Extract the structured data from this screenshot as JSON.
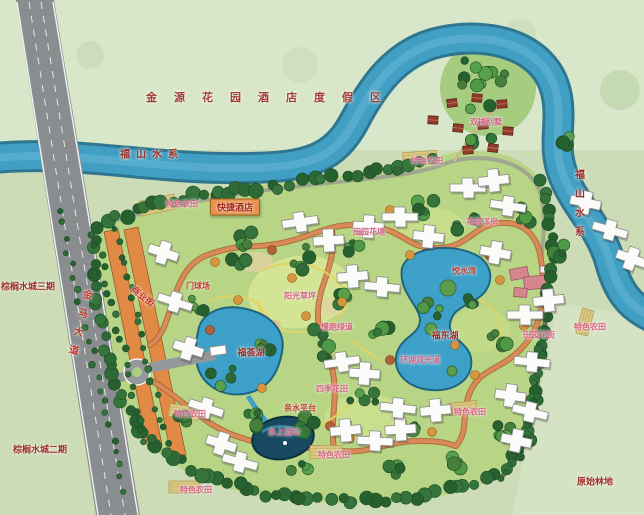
{
  "map": {
    "type": "resort-master-plan",
    "title": "金源花园酒店度假区",
    "colors": {
      "background_green": "#ccdcb6",
      "top_area_green": "#d8e7c9",
      "site_lawn": "#b7d584",
      "river_water": "#419fc3",
      "river_edge": "#26708e",
      "lake_water": "#3da0c8",
      "dark_pond": "#174a60",
      "main_road_grey": "#898d90",
      "internal_road": "#d98a58",
      "commercial_orange": "#e08a45",
      "building_white": "#fbfbf9",
      "villa_red": "#8e3b2c",
      "clubhouse_pink": "#d6868f",
      "label_pink": "#d46184",
      "label_red": "#c13a2d",
      "label_dark_red": "#9c2f27"
    }
  },
  "labels": [
    {
      "name": "resort-area-title",
      "text": "金源花园酒店度假区",
      "x": 272,
      "y": 97,
      "cls": "lbl-spaced",
      "fs": 11
    },
    {
      "name": "river-name-west",
      "text": "福山水系",
      "x": 152,
      "y": 153,
      "cls": "lbl-dark lbl-sp6",
      "fs": 10
    },
    {
      "name": "river-name-east",
      "text": "福山水系",
      "x": 578,
      "y": 207,
      "cls": "lbl-dark lbl-vert",
      "fs": 10
    },
    {
      "name": "palm-water-city-phase3",
      "text": "棕榈水城三期",
      "x": 28,
      "y": 286,
      "cls": "lbl-dark",
      "fs": 9
    },
    {
      "name": "palm-water-city-phase2",
      "text": "棕榈水城二期",
      "x": 40,
      "y": 449,
      "cls": "lbl-dark",
      "fs": 9
    },
    {
      "name": "jinma-avenue",
      "text": "金马大道",
      "x": 78,
      "y": 326,
      "cls": "lbl-red lbl-vert",
      "fs": 10,
      "rot": 14
    },
    {
      "name": "farm-plot-northwest",
      "text": "特色农田",
      "x": 182,
      "y": 204,
      "cls": "lbl-pink",
      "fs": 8
    },
    {
      "name": "express-hotel",
      "text": "快捷酒店",
      "x": 235,
      "y": 207,
      "cls": "lbl-box",
      "fs": 9
    },
    {
      "name": "duplex-villas",
      "text": "双拼别墅",
      "x": 486,
      "y": 122,
      "cls": "lbl-pink",
      "fs": 8
    },
    {
      "name": "farm-plot-north",
      "text": "特色农田",
      "x": 427,
      "y": 161,
      "cls": "lbl-pink",
      "fs": 8
    },
    {
      "name": "pastoral-flower-border",
      "text": "田园花境",
      "x": 369,
      "y": 232,
      "cls": "lbl-pink",
      "fs": 8
    },
    {
      "name": "garden-houses",
      "text": "花园洋房",
      "x": 482,
      "y": 222,
      "cls": "lbl-pink",
      "fs": 8
    },
    {
      "name": "sunshine-lawn",
      "text": "阳光草坪",
      "x": 300,
      "y": 296,
      "cls": "lbl-pink",
      "fs": 8
    },
    {
      "name": "jogging-greenway",
      "text": "慢跑绿道",
      "x": 337,
      "y": 327,
      "cls": "lbl-pink",
      "fs": 8
    },
    {
      "name": "west-lake-name",
      "text": "福荟湖",
      "x": 251,
      "y": 352,
      "cls": "lbl-dark",
      "fs": 9
    },
    {
      "name": "commercial-street",
      "text": "商业街",
      "x": 143,
      "y": 296,
      "cls": "lbl-red",
      "fs": 9,
      "rot": 38
    },
    {
      "name": "gateball-court",
      "text": "门球场",
      "x": 198,
      "y": 286,
      "cls": "lbl-red",
      "fs": 8
    },
    {
      "name": "lakeside-club",
      "text": "悦水湾",
      "x": 464,
      "y": 271,
      "cls": "lbl-red",
      "fs": 8
    },
    {
      "name": "east-lake-name",
      "text": "福东湖",
      "x": 445,
      "y": 335,
      "cls": "lbl-dark",
      "fs": 9
    },
    {
      "name": "lake-tour-path",
      "text": "环湖观光道",
      "x": 420,
      "y": 360,
      "cls": "lbl-pink",
      "fs": 8
    },
    {
      "name": "four-seasons-flower-field",
      "text": "四季花田",
      "x": 332,
      "y": 389,
      "cls": "lbl-pink",
      "fs": 8
    },
    {
      "name": "waterfront-platform",
      "text": "亲水平台",
      "x": 300,
      "y": 408,
      "cls": "lbl-red",
      "fs": 8
    },
    {
      "name": "water-sports",
      "text": "水上运动",
      "x": 284,
      "y": 432,
      "cls": "lbl-pink",
      "fs": 8
    },
    {
      "name": "pastoral-flower-street",
      "text": "田园花街",
      "x": 539,
      "y": 335,
      "cls": "lbl-pink",
      "fs": 8
    },
    {
      "name": "farm-plot-east",
      "text": "特色农田",
      "x": 590,
      "y": 327,
      "cls": "lbl-pink",
      "fs": 8
    },
    {
      "name": "farm-plot-southwest",
      "text": "特色农田",
      "x": 190,
      "y": 414,
      "cls": "lbl-pink",
      "fs": 8
    },
    {
      "name": "farm-plot-south",
      "text": "特色农田",
      "x": 334,
      "y": 455,
      "cls": "lbl-pink",
      "fs": 8
    },
    {
      "name": "farm-plot-southeast",
      "text": "特色农田",
      "x": 470,
      "y": 412,
      "cls": "lbl-pink",
      "fs": 8
    },
    {
      "name": "farm-plot-bottom",
      "text": "特色农田",
      "x": 196,
      "y": 490,
      "cls": "lbl-pink",
      "fs": 8
    },
    {
      "name": "primeval-forest",
      "text": "原始林地",
      "x": 595,
      "y": 481,
      "cls": "lbl-dark",
      "fs": 9
    }
  ]
}
